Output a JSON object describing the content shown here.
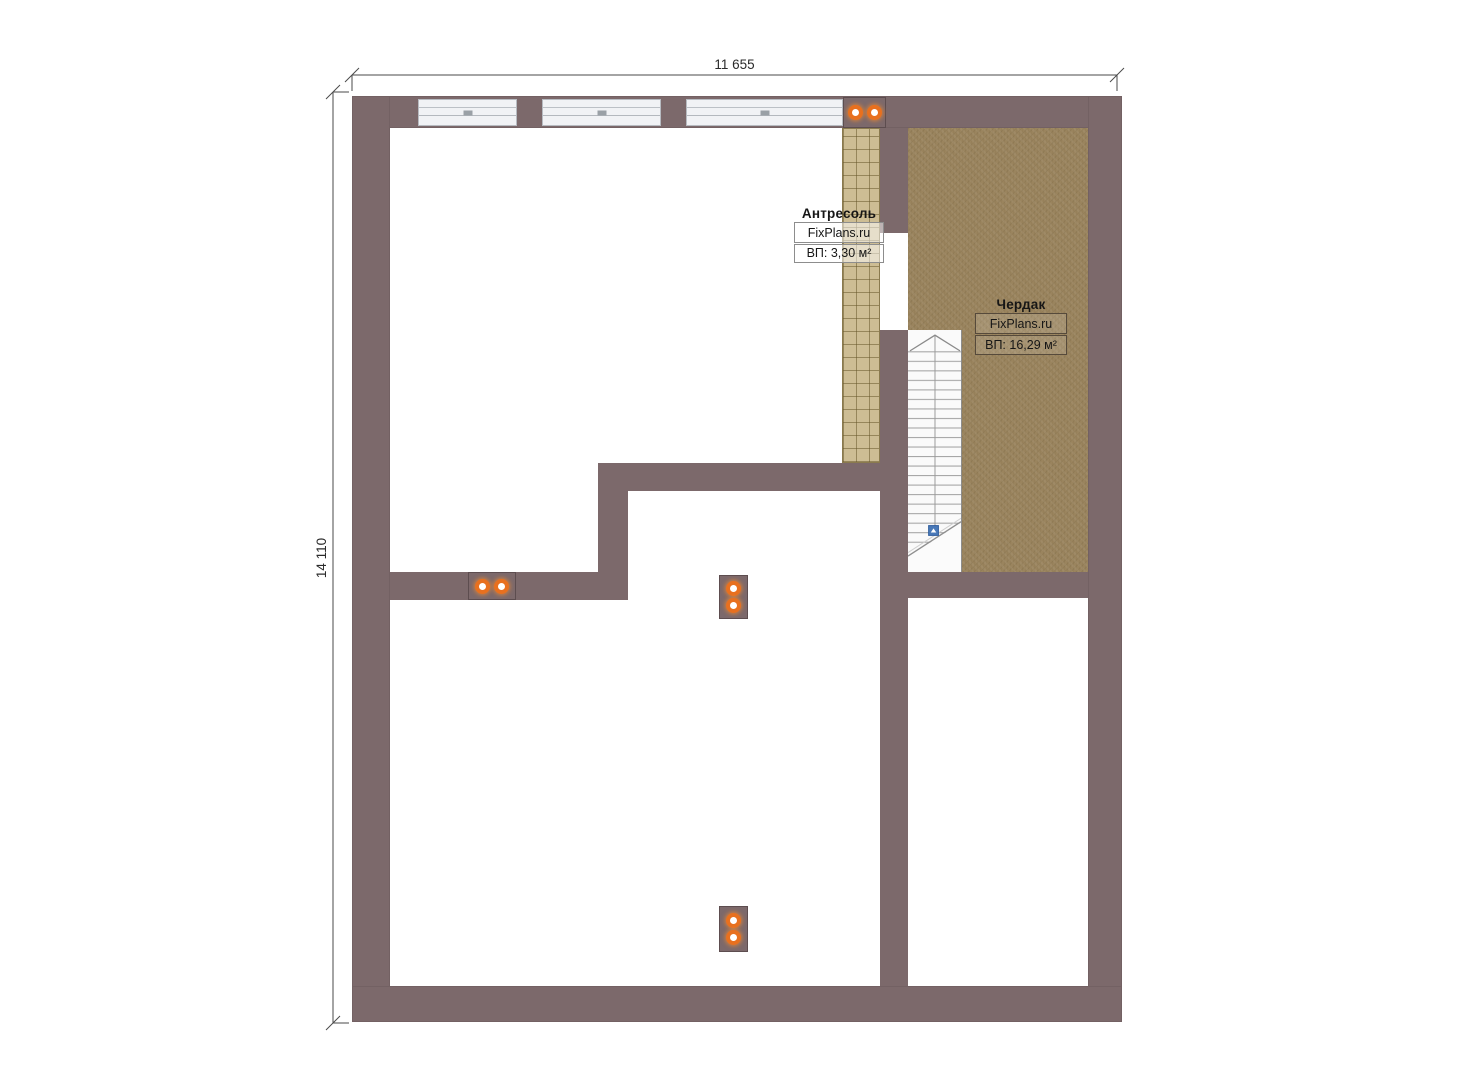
{
  "dimensions": {
    "width_label": "11 655",
    "height_label": "14 110"
  },
  "rooms": {
    "mezzanine": {
      "name": "Антресоль",
      "watermark": "FixPlans.ru",
      "area": "ВП: 3,30 м²"
    },
    "attic": {
      "name": "Чердак",
      "watermark": "FixPlans.ru",
      "area": "ВП: 16,29 м²"
    }
  },
  "icons": {
    "vent": "orange double-dot ventilation/chimney marker",
    "stair_marker": "blue stair start marker with up arrow"
  },
  "colors": {
    "wall": "#7c696b",
    "attic_floor": "#9a845e",
    "mezzanine_floor": "#cdbd94",
    "vent_orange": "#e8701f",
    "stair_marker_blue": "#4a79b8",
    "dim_text": "#2b2b2b"
  }
}
